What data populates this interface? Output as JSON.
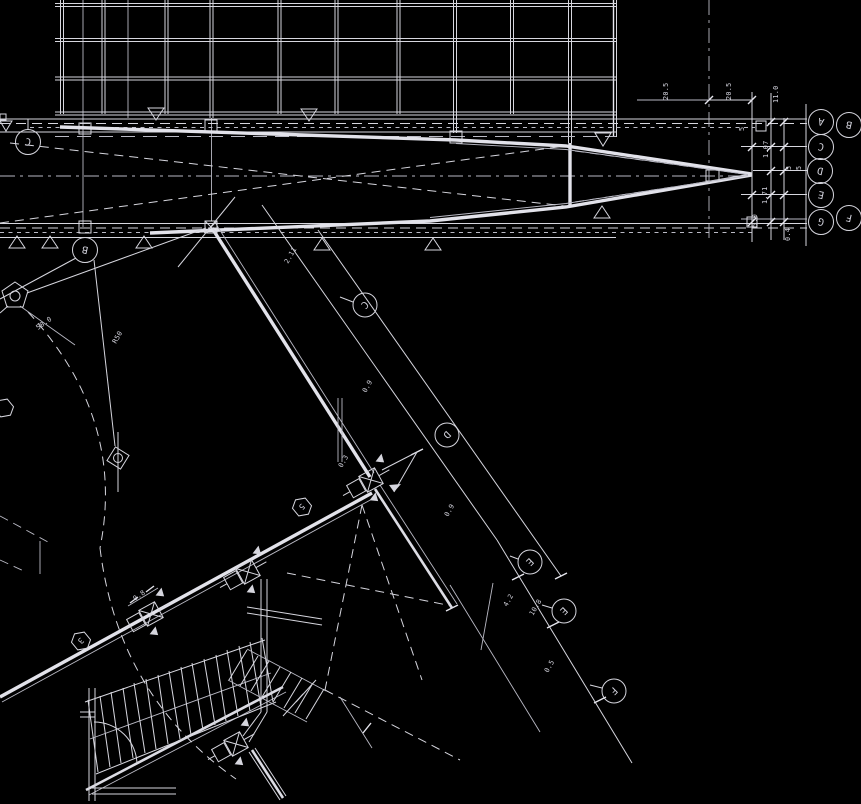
{
  "meta": {
    "description": "CAD architectural floor plan on black background: curtain-wall grid top, long tapered pier with braced bands, rotated lower wing with stair, lettered grid bubbles and small dimensions"
  },
  "colors": {
    "background": "#000000",
    "line": "#d6d6de",
    "line_bright": "#e6e6ee",
    "line_dim": "#b9b9c4",
    "text": "#d2d2dc"
  },
  "grid_bubbles": {
    "left": [
      {
        "letter": "C"
      },
      {
        "letter": "B"
      }
    ],
    "wing": [
      {
        "letter": "C"
      },
      {
        "letter": "D"
      },
      {
        "letter": "E"
      },
      {
        "letter": "E"
      },
      {
        "letter": "F"
      }
    ],
    "right": [
      {
        "letter": "A"
      },
      {
        "letter": "B"
      },
      {
        "letter": "C"
      },
      {
        "letter": "D"
      },
      {
        "letter": "E"
      },
      {
        "letter": "G"
      },
      {
        "letter": "F"
      }
    ]
  },
  "dims": {
    "right": [
      "20.5",
      "20.5",
      "11.0",
      "1.07",
      "5",
      "5",
      "1.71",
      "5.0",
      "0.4",
      "5"
    ],
    "wing": [
      "2.11",
      "0.9",
      "0.9",
      "4.2",
      "10.8",
      "0.5"
    ],
    "left": [
      "58.0",
      "R50",
      "0.3",
      "0.8"
    ]
  },
  "detail_tags": [
    {
      "label": "5"
    },
    {
      "label": "3"
    }
  ]
}
